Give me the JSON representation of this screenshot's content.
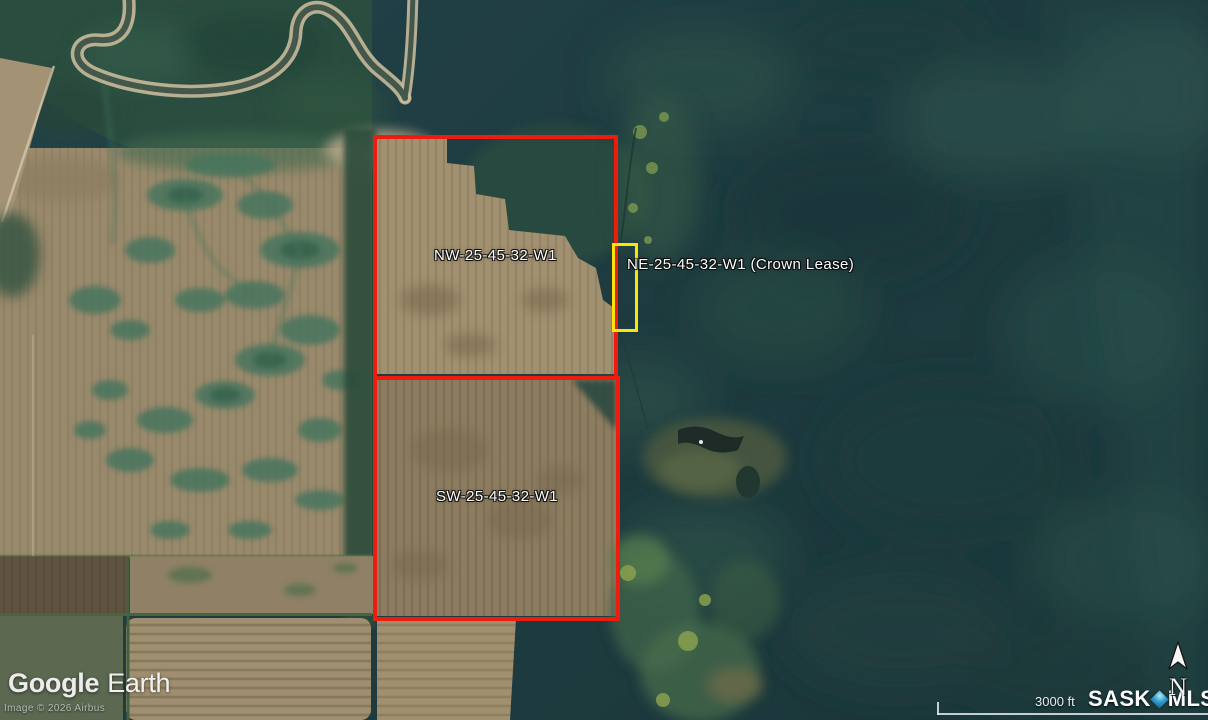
{
  "watermark": {
    "google": "Google",
    "earth": "Earth"
  },
  "copyright": "Image © 2026 Airbus",
  "scale": {
    "label": "3000 ft"
  },
  "branding": {
    "sask": "SASK",
    "mls": "MLS",
    "registered": "®"
  },
  "compass": {
    "north": "N"
  },
  "parcels": [
    {
      "label": "NW-25-45-32-W1"
    },
    {
      "label": "SW-25-45-32-W1"
    },
    {
      "label": "NE-25-45-32-W1 (Crown Lease)"
    }
  ],
  "colors": {
    "boundary_red": "#ee1b0f",
    "lease_yellow": "#f9e40b",
    "mls_blue": "#2f9fd0",
    "label_white": "#fdfdfd"
  }
}
